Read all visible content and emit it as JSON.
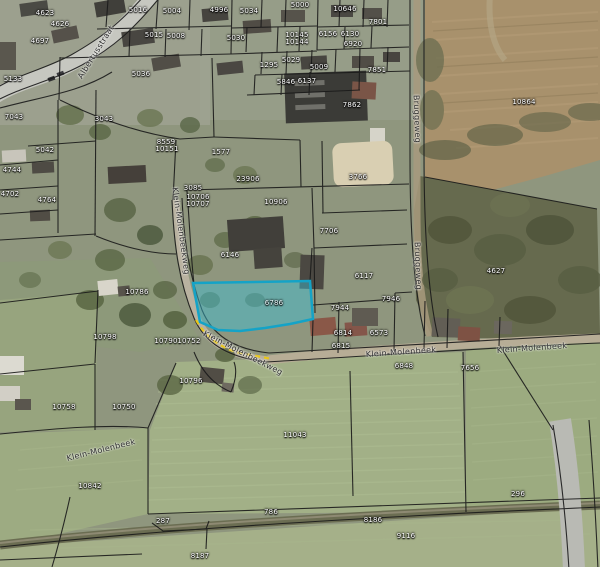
{
  "app": {
    "type": "cadastral-aerial-map-viewer"
  },
  "map": {
    "highlighted_parcel": {
      "label": "6786",
      "fill_color": "#3bc0d8",
      "border_color": "#14a3c7"
    },
    "road_marking": {
      "color": "#e8c619",
      "style": "dashed"
    },
    "parcel_labels": [
      {
        "text": "4623",
        "x": 45,
        "y": 13
      },
      {
        "text": "4626",
        "x": 60,
        "y": 24
      },
      {
        "text": "4697",
        "x": 40,
        "y": 41
      },
      {
        "text": "5133",
        "x": 13,
        "y": 79
      },
      {
        "text": "5016",
        "x": 138,
        "y": 10
      },
      {
        "text": "5004",
        "x": 172,
        "y": 11
      },
      {
        "text": "4996",
        "x": 219,
        "y": 10
      },
      {
        "text": "5034",
        "x": 249,
        "y": 11
      },
      {
        "text": "5000",
        "x": 300,
        "y": 5
      },
      {
        "text": "10646",
        "x": 345,
        "y": 9
      },
      {
        "text": "5015",
        "x": 154,
        "y": 35
      },
      {
        "text": "5008",
        "x": 176,
        "y": 36
      },
      {
        "text": "5030",
        "x": 236,
        "y": 38
      },
      {
        "text": "10145",
        "x": 297,
        "y": 35
      },
      {
        "text": "10144",
        "x": 297,
        "y": 42
      },
      {
        "text": "6156",
        "x": 328,
        "y": 34
      },
      {
        "text": "6130",
        "x": 350,
        "y": 34
      },
      {
        "text": "6920",
        "x": 353,
        "y": 44
      },
      {
        "text": "7801",
        "x": 378,
        "y": 22
      },
      {
        "text": "5029",
        "x": 291,
        "y": 60
      },
      {
        "text": "1295",
        "x": 269,
        "y": 65
      },
      {
        "text": "5009",
        "x": 319,
        "y": 67
      },
      {
        "text": "7851",
        "x": 377,
        "y": 70
      },
      {
        "text": "5846",
        "x": 286,
        "y": 82
      },
      {
        "text": "6137",
        "x": 307,
        "y": 81
      },
      {
        "text": "5036",
        "x": 141,
        "y": 74
      },
      {
        "text": "3043",
        "x": 104,
        "y": 119
      },
      {
        "text": "7043",
        "x": 14,
        "y": 117
      },
      {
        "text": "8559",
        "x": 166,
        "y": 142
      },
      {
        "text": "10151",
        "x": 167,
        "y": 149
      },
      {
        "text": "5042",
        "x": 45,
        "y": 150
      },
      {
        "text": "4744",
        "x": 12,
        "y": 170
      },
      {
        "text": "4702",
        "x": 10,
        "y": 194
      },
      {
        "text": "4764",
        "x": 47,
        "y": 200
      },
      {
        "text": "1577",
        "x": 221,
        "y": 152
      },
      {
        "text": "23906",
        "x": 248,
        "y": 179
      },
      {
        "text": "3085",
        "x": 193,
        "y": 188
      },
      {
        "text": "10706",
        "x": 198,
        "y": 197
      },
      {
        "text": "10707",
        "x": 198,
        "y": 204
      },
      {
        "text": "10906",
        "x": 276,
        "y": 202
      },
      {
        "text": "6146",
        "x": 230,
        "y": 255
      },
      {
        "text": "7706",
        "x": 329,
        "y": 231
      },
      {
        "text": "3766",
        "x": 358,
        "y": 177
      },
      {
        "text": "7862",
        "x": 352,
        "y": 105
      },
      {
        "text": "10864",
        "x": 524,
        "y": 102
      },
      {
        "text": "6117",
        "x": 364,
        "y": 276
      },
      {
        "text": "4627",
        "x": 496,
        "y": 271
      },
      {
        "text": "6786",
        "x": 274,
        "y": 303,
        "highlighted": true
      },
      {
        "text": "7944",
        "x": 340,
        "y": 308
      },
      {
        "text": "7946",
        "x": 391,
        "y": 299
      },
      {
        "text": "6814",
        "x": 343,
        "y": 333
      },
      {
        "text": "6573",
        "x": 379,
        "y": 333
      },
      {
        "text": "6815",
        "x": 341,
        "y": 346
      },
      {
        "text": "7656",
        "x": 470,
        "y": 368
      },
      {
        "text": "6848",
        "x": 404,
        "y": 366
      },
      {
        "text": "10786",
        "x": 137,
        "y": 292
      },
      {
        "text": "10798",
        "x": 105,
        "y": 337
      },
      {
        "text": "10790",
        "x": 166,
        "y": 341
      },
      {
        "text": "10752",
        "x": 189,
        "y": 341
      },
      {
        "text": "10796",
        "x": 191,
        "y": 381
      },
      {
        "text": "10758",
        "x": 64,
        "y": 407
      },
      {
        "text": "10750",
        "x": 124,
        "y": 407
      },
      {
        "text": "10842",
        "x": 90,
        "y": 486
      },
      {
        "text": "11043",
        "x": 295,
        "y": 435
      },
      {
        "text": "287",
        "x": 163,
        "y": 521
      },
      {
        "text": "786",
        "x": 271,
        "y": 512
      },
      {
        "text": "8186",
        "x": 373,
        "y": 520
      },
      {
        "text": "8187",
        "x": 200,
        "y": 556
      },
      {
        "text": "9116",
        "x": 406,
        "y": 536
      },
      {
        "text": "296",
        "x": 518,
        "y": 494
      }
    ],
    "street_labels": [
      {
        "text": "Albertusstraat",
        "x": 96,
        "y": 52,
        "angle": -58
      },
      {
        "text": "Klein-Molenbeekweg",
        "x": 181,
        "y": 231,
        "angle": 82
      },
      {
        "text": "Klein-Molenbeekweg",
        "x": 243,
        "y": 353,
        "angle": 27
      },
      {
        "text": "Bruggeweg",
        "x": 417,
        "y": 119,
        "angle": 88
      },
      {
        "text": "Bruggeweg",
        "x": 418,
        "y": 266,
        "angle": 88
      },
      {
        "text": "Klein-Molenbeek",
        "x": 401,
        "y": 352,
        "angle": -4
      },
      {
        "text": "Klein-Molenbeek",
        "x": 532,
        "y": 348,
        "angle": -4
      },
      {
        "text": "Klein-Molenbeek",
        "x": 101,
        "y": 450,
        "angle": -14
      }
    ]
  }
}
